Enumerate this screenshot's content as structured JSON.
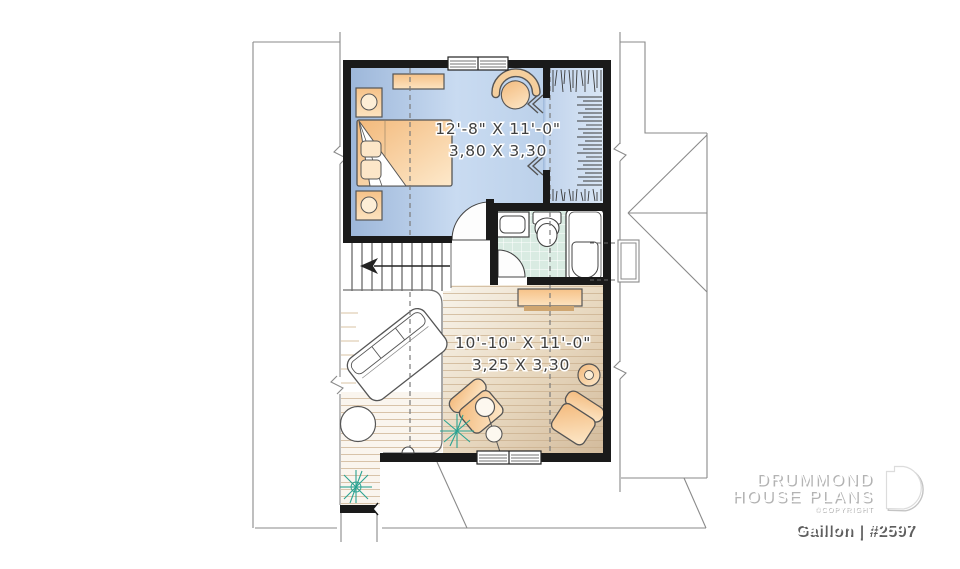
{
  "plan_title": "Gaillon | #2597",
  "brand": {
    "line1": "DRUMMOND",
    "line2": "HOUSE PLANS",
    "copyright": "©COPYRIGHT"
  },
  "rooms": {
    "bedroom": {
      "dim_imperial": "12'-8\" X 11'-0\"",
      "dim_metric": "3,80 X 3,30"
    },
    "living_room": {
      "dim_imperial": "10'-10\" X 11'-0\"",
      "dim_metric": "3,25 X 3,30"
    }
  },
  "colors": {
    "wall": "#1a1a1a",
    "bedroom_floor": "#a6bedf",
    "closet_floor": "#cfdeef",
    "bathroom_tile": "#d9ebe2",
    "wood_floor": "#e4d2b8",
    "furniture_orange": "#f5c68c",
    "plant_teal": "#2aa392",
    "roof_line": "#8a8a8a",
    "dim_text": "#3f3f3f"
  }
}
